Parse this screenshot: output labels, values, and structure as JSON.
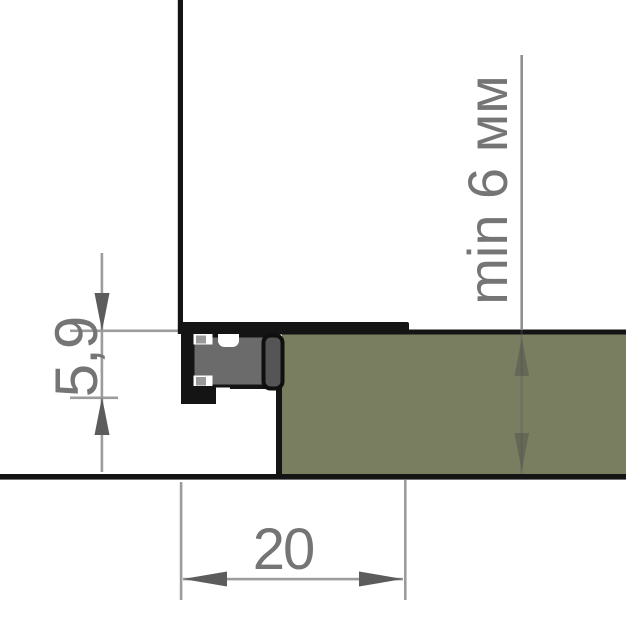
{
  "drawing": {
    "kind": "profile-cross-section",
    "dimensions": {
      "profile_height_label": "5,9",
      "profile_width_label": "20",
      "panel_thickness_label": "min 6 мм"
    },
    "colors": {
      "background": "#ffffff",
      "outline_black": "#141414",
      "panel_olive": "#7a7e60",
      "insert_gray": "#6b6b6b",
      "cap_gray": "#555555",
      "slot_block_gray": "#999999",
      "dimension_line_gray": "#9c9c9c",
      "arrow_gray": "#5c5c5c",
      "label_gray": "#757575"
    }
  }
}
